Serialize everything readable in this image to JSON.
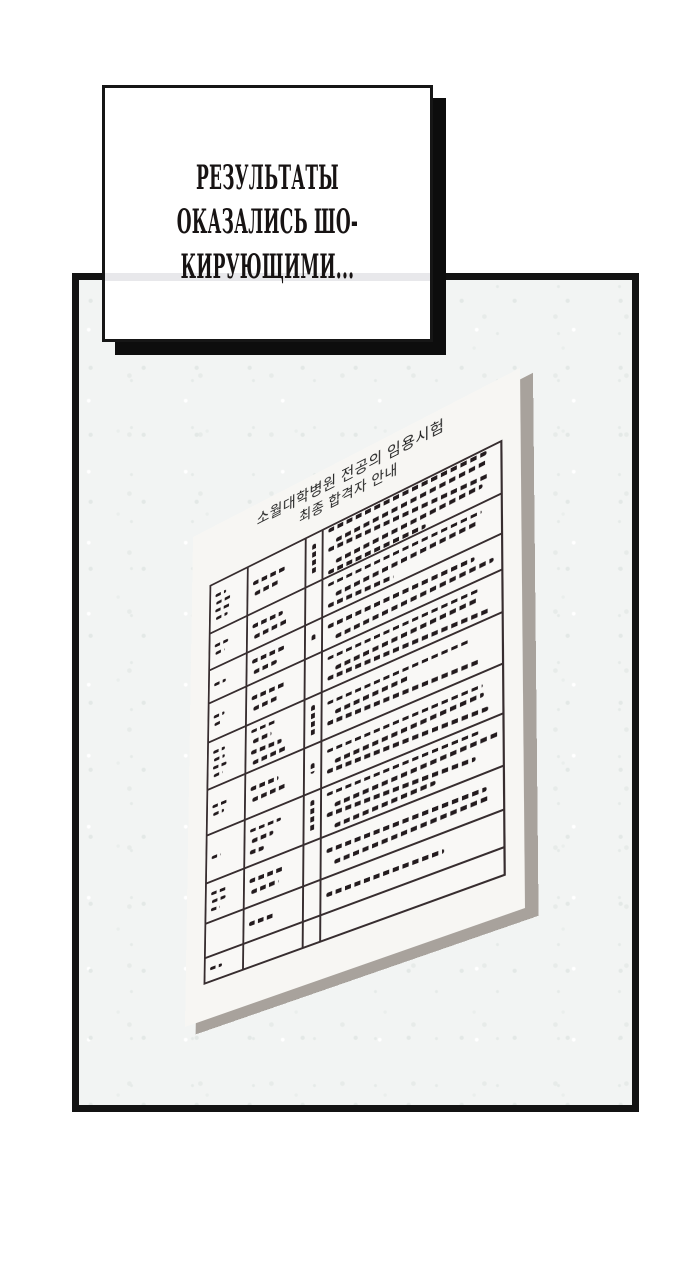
{
  "caption": {
    "lines": [
      "РЕЗУЛЬТАТЫ",
      "ОКАЗАЛИСЬ ШО-",
      "КИРУЮЩИМИ..."
    ]
  },
  "paper": {
    "title_line1": "소월대학병원 전공의 임용시험",
    "title_line2": "최종 합격자 안내",
    "table": {
      "columns": [
        14,
        21,
        6,
        59
      ],
      "rows": [
        {
          "h": 48,
          "a": [
            40,
            55,
            65,
            45
          ],
          "b": [
            70,
            55
          ],
          "c": 70,
          "d": [
            95,
            90,
            96,
            88,
            60
          ]
        },
        {
          "h": 38,
          "a": [
            50,
            35
          ],
          "b": [
            65,
            72
          ],
          "c": 0,
          "d": [
            92,
            85,
            40
          ]
        },
        {
          "h": 34,
          "a": [
            45
          ],
          "b": [
            70,
            50
          ],
          "c": 30,
          "d": [
            88,
            94
          ]
        },
        {
          "h": 40,
          "a": [
            40,
            30
          ],
          "b": [
            75,
            55
          ],
          "c": 0,
          "d": [
            90,
            85,
            96
          ]
        },
        {
          "h": 48,
          "a": [
            45,
            40,
            50,
            35
          ],
          "b": [
            55,
            40,
            65,
            70
          ],
          "c": 75,
          "d": [
            85,
            45,
            90
          ]
        },
        {
          "h": 46,
          "a": [
            55,
            40
          ],
          "b": [
            60,
            70
          ],
          "c": 25,
          "d": [
            92,
            88,
            95
          ]
        },
        {
          "h": 48,
          "a": [
            35
          ],
          "b": [
            65,
            45,
            30
          ],
          "c": 80,
          "d": [
            90,
            96,
            88,
            60
          ]
        },
        {
          "h": 40,
          "a": [
            60,
            50,
            35
          ],
          "b": [
            72,
            58
          ],
          "c": 0,
          "d": [
            94,
            90
          ]
        },
        {
          "h": 34,
          "a": [],
          "b": [
            55
          ],
          "c": 0,
          "d": [
            70
          ]
        },
        {
          "h": 25,
          "a": [
            45
          ],
          "b": [],
          "c": 0,
          "d": []
        }
      ]
    }
  },
  "colors": {
    "panel_border": "#131313",
    "wall": "#f2f4f3",
    "paper": "#f7f6f3",
    "paper_shadow": "#a8a29c",
    "ink": "#231b1e",
    "table_line": "#372d2f",
    "caption_border": "#161616",
    "caption_shadow": "#0d0d0d",
    "band": "#e8e8eb",
    "text": "#171313"
  }
}
